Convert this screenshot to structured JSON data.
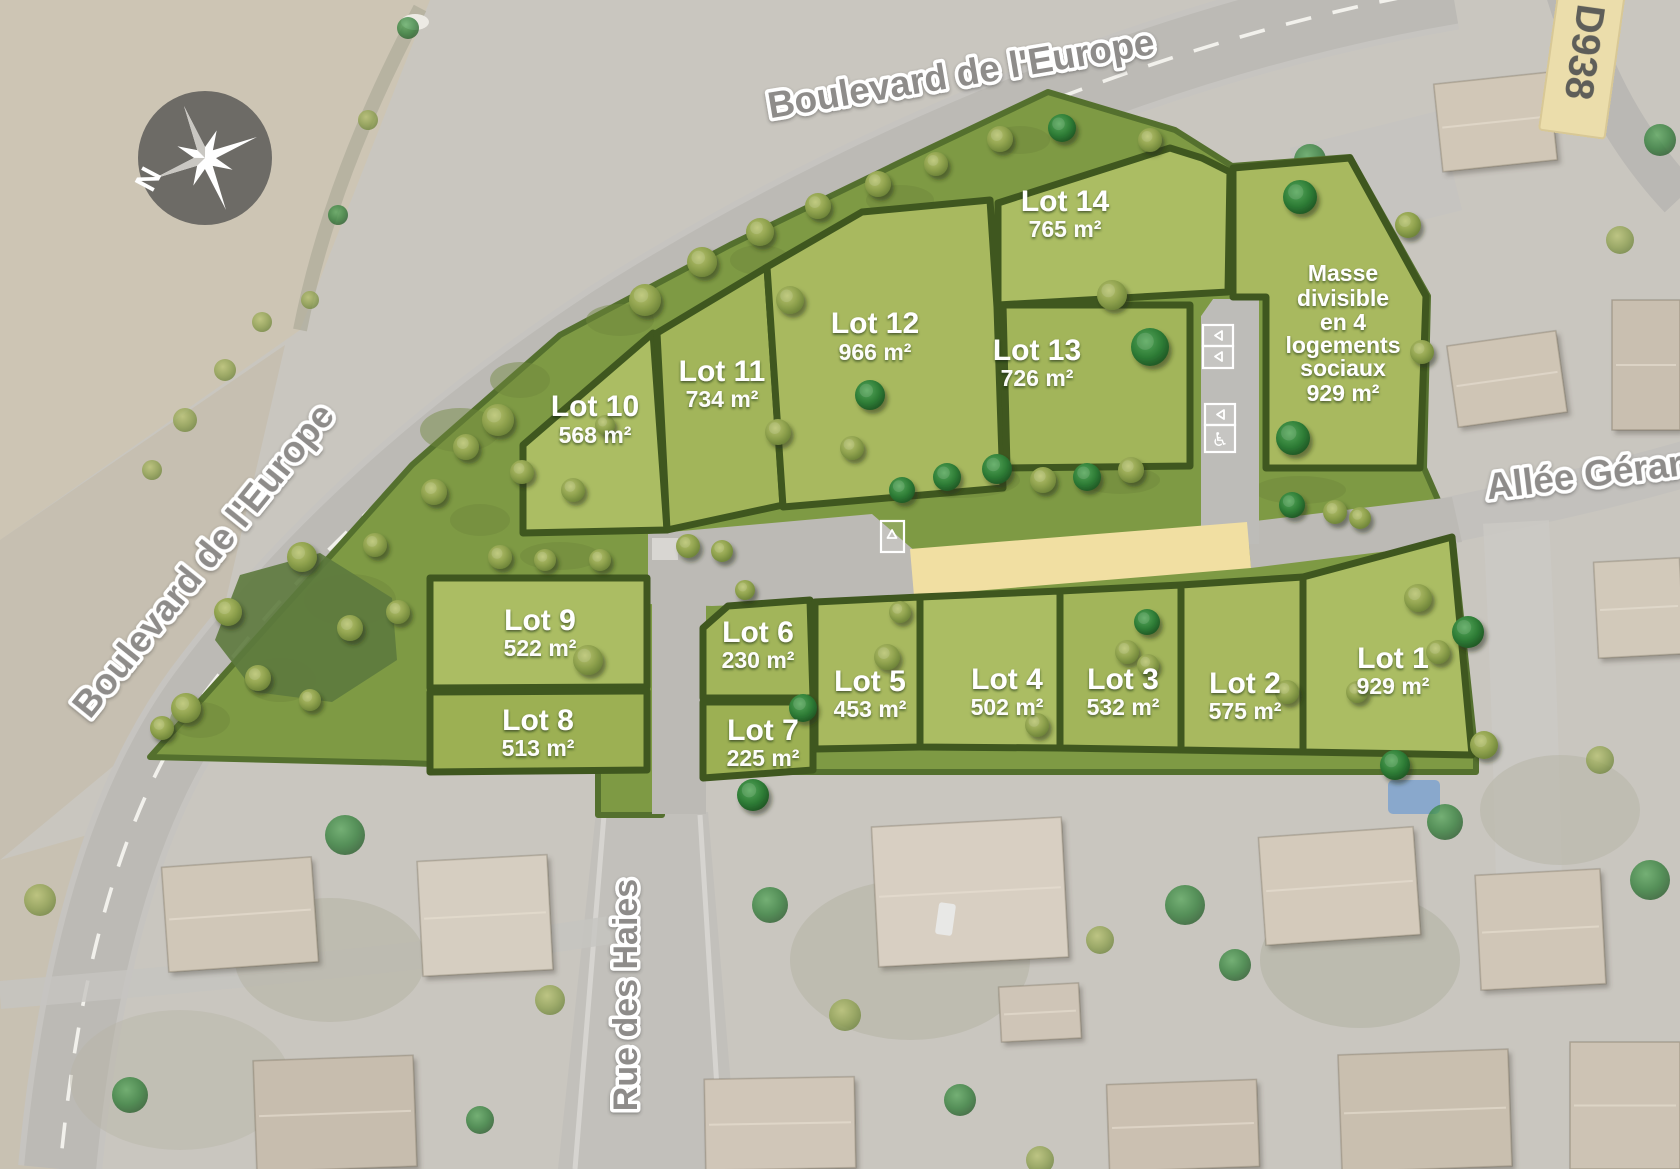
{
  "compass": {
    "label": "N"
  },
  "road_badge": {
    "label": "D938"
  },
  "streets": {
    "top": "Boulevard de l'Europe",
    "west": "Boulevard de l'Europe",
    "east": "Allée Gérard",
    "south": "Rue des Haies"
  },
  "lots": [
    {
      "id": "lot-1",
      "label": "Lot 1",
      "area": "929 m²"
    },
    {
      "id": "lot-2",
      "label": "Lot 2",
      "area": "575 m²"
    },
    {
      "id": "lot-3",
      "label": "Lot 3",
      "area": "532 m²"
    },
    {
      "id": "lot-4",
      "label": "Lot 4",
      "area": "502 m²"
    },
    {
      "id": "lot-5",
      "label": "Lot 5",
      "area": "453 m²"
    },
    {
      "id": "lot-6",
      "label": "Lot 6",
      "area": "230 m²"
    },
    {
      "id": "lot-7",
      "label": "Lot 7",
      "area": "225 m²"
    },
    {
      "id": "lot-8",
      "label": "Lot 8",
      "area": "513 m²"
    },
    {
      "id": "lot-9",
      "label": "Lot 9",
      "area": "522 m²"
    },
    {
      "id": "lot-10",
      "label": "Lot 10",
      "area": "568 m²"
    },
    {
      "id": "lot-11",
      "label": "Lot 11",
      "area": "734 m²"
    },
    {
      "id": "lot-12",
      "label": "Lot 12",
      "area": "966 m²"
    },
    {
      "id": "lot-13",
      "label": "Lot 13",
      "area": "726 m²"
    },
    {
      "id": "lot-14",
      "label": "Lot 14",
      "area": "765 m²"
    },
    {
      "id": "masse",
      "label": "Masse divisible en 4 logements sociaux",
      "label_lines": [
        "Masse",
        "divisible",
        "en 4",
        "logements",
        "sociaux"
      ],
      "area": "929 m²"
    }
  ],
  "icons": {
    "wheelchair": "♿"
  },
  "colors": {
    "lot_green": "#a2b55a",
    "hedge_green": "#3f571f",
    "scrub_green": "#7e9a44",
    "road_gray": "#bcbab5",
    "path_yellow": "#f1dfa2",
    "badge_cream": "#ebddab",
    "street_label_gray": "#8e8c8a",
    "label_white": "#ffffff",
    "aerial_base": "#c9c6bf",
    "field_tan": "#cdc5b4",
    "compass_gray": "#6d6b66"
  }
}
